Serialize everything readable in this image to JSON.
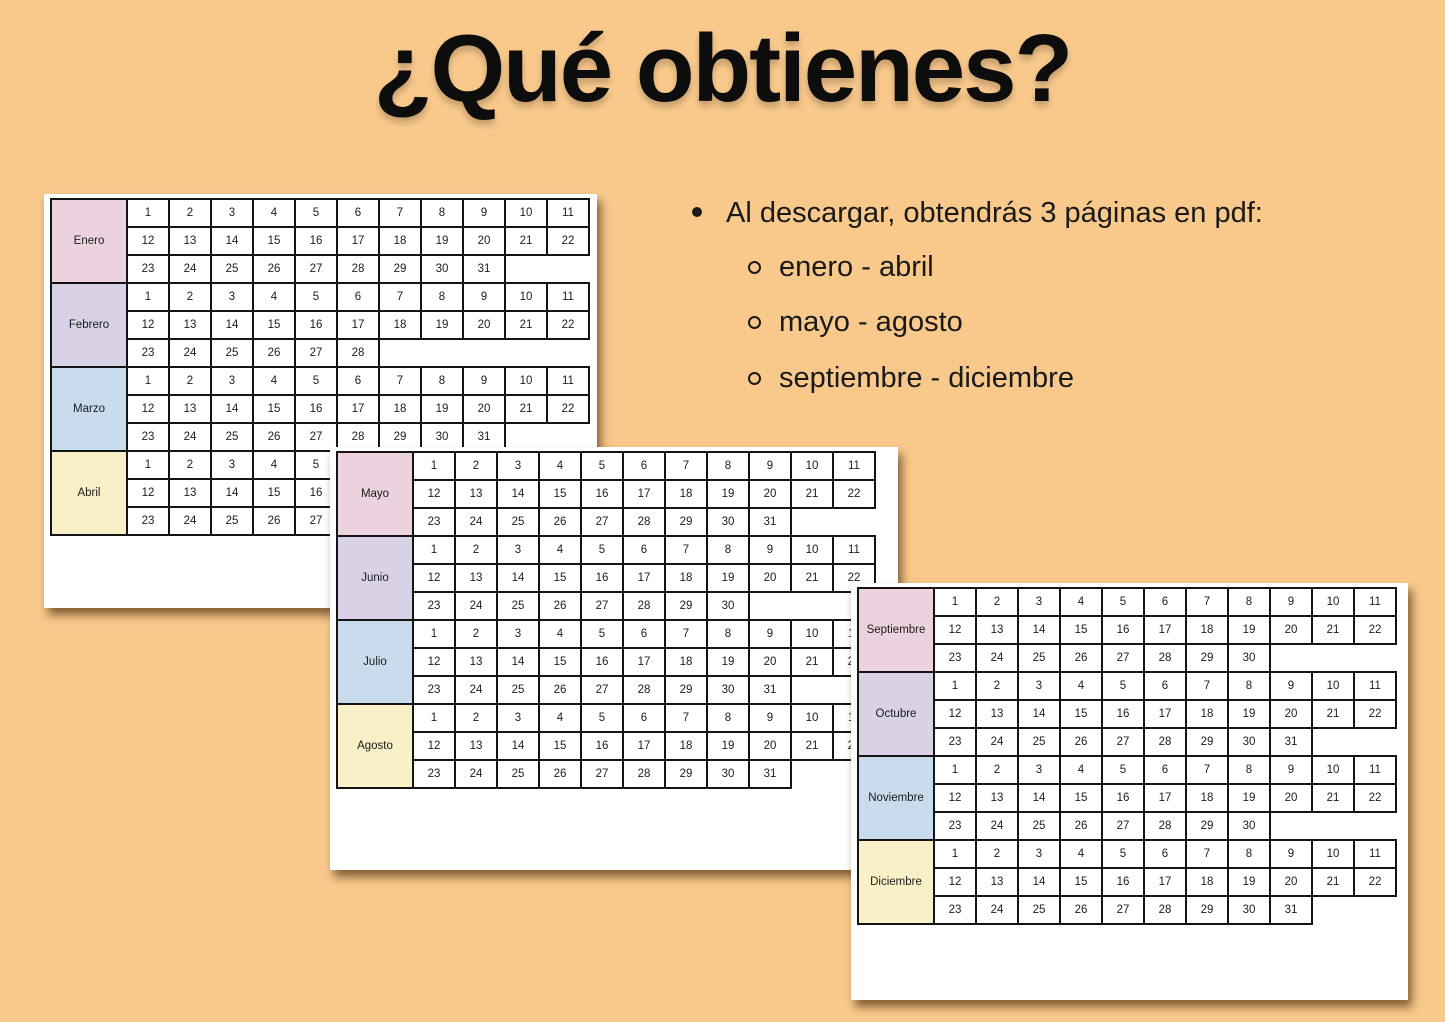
{
  "title": "¿Qué obtienes?",
  "bullets": {
    "main": "Al descargar, obtendrás 3 páginas en pdf:",
    "sub": [
      "enero - abril",
      "mayo - agosto",
      "septiembre - diciembre"
    ]
  },
  "colors": {
    "background": "#F9C98C",
    "page_background": "#FFFFFF",
    "cell_border": "#141414",
    "text": "#1A1A1A",
    "month_colors": {
      "pink": "#ECD2DF",
      "lavender": "#D9D2E6",
      "blue": "#C9DCEE",
      "yellow": "#FAF0C8"
    }
  },
  "pages": [
    {
      "name": "enero-abril",
      "months": [
        {
          "label": "Enero",
          "color": "pink",
          "rows": [
            [
              1,
              2,
              3,
              4,
              5,
              6,
              7,
              8,
              9,
              10,
              11
            ],
            [
              12,
              13,
              14,
              15,
              16,
              17,
              18,
              19,
              20,
              21,
              22
            ],
            [
              23,
              24,
              25,
              26,
              27,
              28,
              29,
              30,
              31
            ]
          ]
        },
        {
          "label": "Febrero",
          "color": "lavender",
          "rows": [
            [
              1,
              2,
              3,
              4,
              5,
              6,
              7,
              8,
              9,
              10,
              11
            ],
            [
              12,
              13,
              14,
              15,
              16,
              17,
              18,
              19,
              20,
              21,
              22
            ],
            [
              23,
              24,
              25,
              26,
              27,
              28
            ]
          ]
        },
        {
          "label": "Marzo",
          "color": "blue",
          "rows": [
            [
              1,
              2,
              3,
              4,
              5,
              6,
              7,
              8,
              9,
              10,
              11
            ],
            [
              12,
              13,
              14,
              15,
              16,
              17,
              18,
              19,
              20,
              21,
              22
            ],
            [
              23,
              24,
              25,
              26,
              27,
              28,
              29,
              30,
              31
            ]
          ]
        },
        {
          "label": "Abril",
          "color": "yellow",
          "rows": [
            [
              1,
              2,
              3,
              4,
              5,
              6,
              7,
              8,
              9,
              10,
              11
            ],
            [
              12,
              13,
              14,
              15,
              16,
              17,
              18,
              19,
              20,
              21,
              22
            ],
            [
              23,
              24,
              25,
              26,
              27,
              28,
              29,
              30
            ]
          ]
        }
      ]
    },
    {
      "name": "mayo-agosto",
      "months": [
        {
          "label": "Mayo",
          "color": "pink",
          "rows": [
            [
              1,
              2,
              3,
              4,
              5,
              6,
              7,
              8,
              9,
              10,
              11
            ],
            [
              12,
              13,
              14,
              15,
              16,
              17,
              18,
              19,
              20,
              21,
              22
            ],
            [
              23,
              24,
              25,
              26,
              27,
              28,
              29,
              30,
              31
            ]
          ]
        },
        {
          "label": "Junio",
          "color": "lavender",
          "rows": [
            [
              1,
              2,
              3,
              4,
              5,
              6,
              7,
              8,
              9,
              10,
              11
            ],
            [
              12,
              13,
              14,
              15,
              16,
              17,
              18,
              19,
              20,
              21,
              22
            ],
            [
              23,
              24,
              25,
              26,
              27,
              28,
              29,
              30
            ]
          ]
        },
        {
          "label": "Julio",
          "color": "blue",
          "rows": [
            [
              1,
              2,
              3,
              4,
              5,
              6,
              7,
              8,
              9,
              10,
              11
            ],
            [
              12,
              13,
              14,
              15,
              16,
              17,
              18,
              19,
              20,
              21,
              22
            ],
            [
              23,
              24,
              25,
              26,
              27,
              28,
              29,
              30,
              31
            ]
          ]
        },
        {
          "label": "Agosto",
          "color": "yellow",
          "rows": [
            [
              1,
              2,
              3,
              4,
              5,
              6,
              7,
              8,
              9,
              10,
              11
            ],
            [
              12,
              13,
              14,
              15,
              16,
              17,
              18,
              19,
              20,
              21,
              22
            ],
            [
              23,
              24,
              25,
              26,
              27,
              28,
              29,
              30,
              31
            ]
          ]
        }
      ]
    },
    {
      "name": "septiembre-diciembre",
      "months": [
        {
          "label": "Septiembre",
          "color": "pink",
          "rows": [
            [
              1,
              2,
              3,
              4,
              5,
              6,
              7,
              8,
              9,
              10,
              11
            ],
            [
              12,
              13,
              14,
              15,
              16,
              17,
              18,
              19,
              20,
              21,
              22
            ],
            [
              23,
              24,
              25,
              26,
              27,
              28,
              29,
              30
            ]
          ]
        },
        {
          "label": "Octubre",
          "color": "lavender",
          "rows": [
            [
              1,
              2,
              3,
              4,
              5,
              6,
              7,
              8,
              9,
              10,
              11
            ],
            [
              12,
              13,
              14,
              15,
              16,
              17,
              18,
              19,
              20,
              21,
              22
            ],
            [
              23,
              24,
              25,
              26,
              27,
              28,
              29,
              30,
              31
            ]
          ]
        },
        {
          "label": "Noviembre",
          "color": "blue",
          "rows": [
            [
              1,
              2,
              3,
              4,
              5,
              6,
              7,
              8,
              9,
              10,
              11
            ],
            [
              12,
              13,
              14,
              15,
              16,
              17,
              18,
              19,
              20,
              21,
              22
            ],
            [
              23,
              24,
              25,
              26,
              27,
              28,
              29,
              30
            ]
          ]
        },
        {
          "label": "Diciembre",
          "color": "yellow",
          "rows": [
            [
              1,
              2,
              3,
              4,
              5,
              6,
              7,
              8,
              9,
              10,
              11
            ],
            [
              12,
              13,
              14,
              15,
              16,
              17,
              18,
              19,
              20,
              21,
              22
            ],
            [
              23,
              24,
              25,
              26,
              27,
              28,
              29,
              30,
              31
            ]
          ]
        }
      ]
    }
  ]
}
